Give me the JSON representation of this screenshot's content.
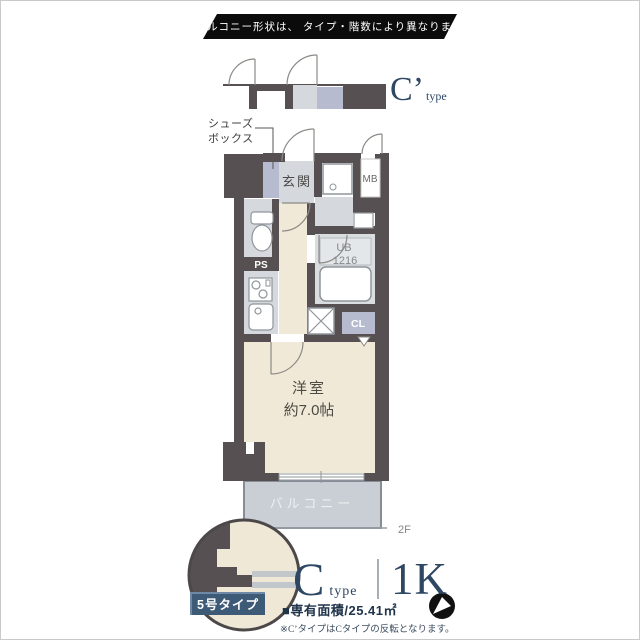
{
  "banner": {
    "text": "※バルコニー形状は、 タイプ・階数により異なります。"
  },
  "mini_plan": {
    "label_main": "C’",
    "label_sub": "type"
  },
  "plan": {
    "shoes_box_line1": "シューズ",
    "shoes_box_line2": "ボックス",
    "entrance": "玄関",
    "meter_box": "MB",
    "pipe_space": "PS",
    "unit_bath": "UB",
    "unit_bath_size": "1216",
    "closet": "CL",
    "room_name": "洋室",
    "room_size": "約7.0帖",
    "balcony": "バルコニー",
    "floor_marker": "2F"
  },
  "callout": {
    "badge": "5号タイプ"
  },
  "footer": {
    "type_main": "C",
    "type_sub": "type",
    "layout": "1K",
    "area": "■専有面積/25.41㎡",
    "note": "※C’タイプはCタイプの反転となります。"
  },
  "colors": {
    "wall": "#575052",
    "accent": "#2e4763",
    "badge": "#3d5a77",
    "balcony": "#c9cfd5"
  }
}
